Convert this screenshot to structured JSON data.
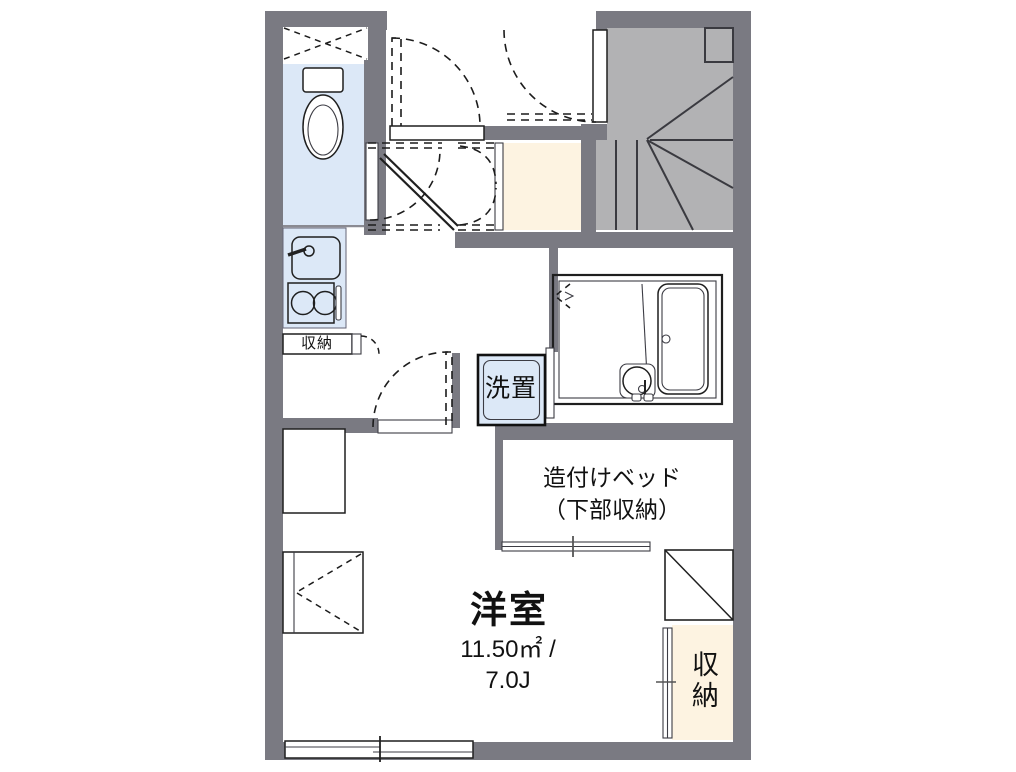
{
  "colors": {
    "background": "#ffffff",
    "wall": "#7a7a82",
    "stairs": "#b2b2b4",
    "water_room": "#dce8f7",
    "storage": "#fdf3e1",
    "line": "#1f1f1f"
  },
  "floorplan": {
    "labels": {
      "kitchen_storage": "収納",
      "laundry": "洗置",
      "bed_line1": "造付けベッド",
      "bed_line2": "（下部収納）",
      "room_name": "洋室",
      "room_area": "11.50㎡ /",
      "room_size": "7.0J",
      "closet": "収納"
    }
  }
}
